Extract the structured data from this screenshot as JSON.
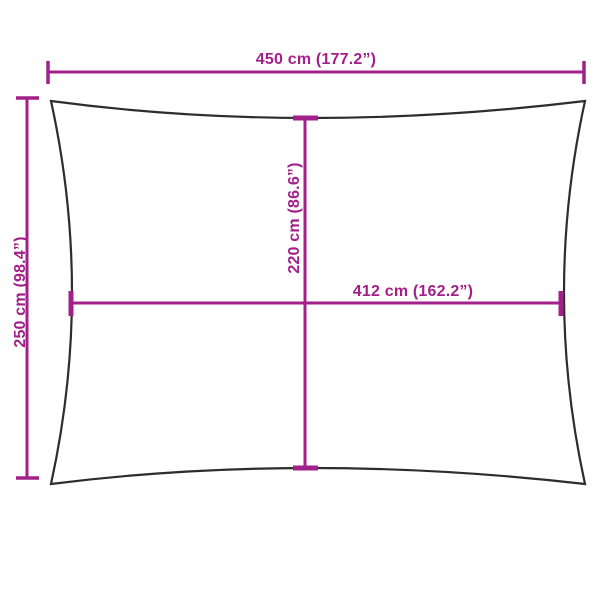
{
  "diagram": {
    "title": "Rectangular shade sail dimension diagram",
    "colors": {
      "background": "#ffffff",
      "outline": "#2d2d2d",
      "dimension": "#a2208a"
    },
    "labels": {
      "width_total": "450 cm (177.2”)",
      "height_total": "250 cm (98.4”)",
      "height_inner": "220 cm (86.6”)",
      "width_inner": "412 cm (162.2”)"
    }
  }
}
